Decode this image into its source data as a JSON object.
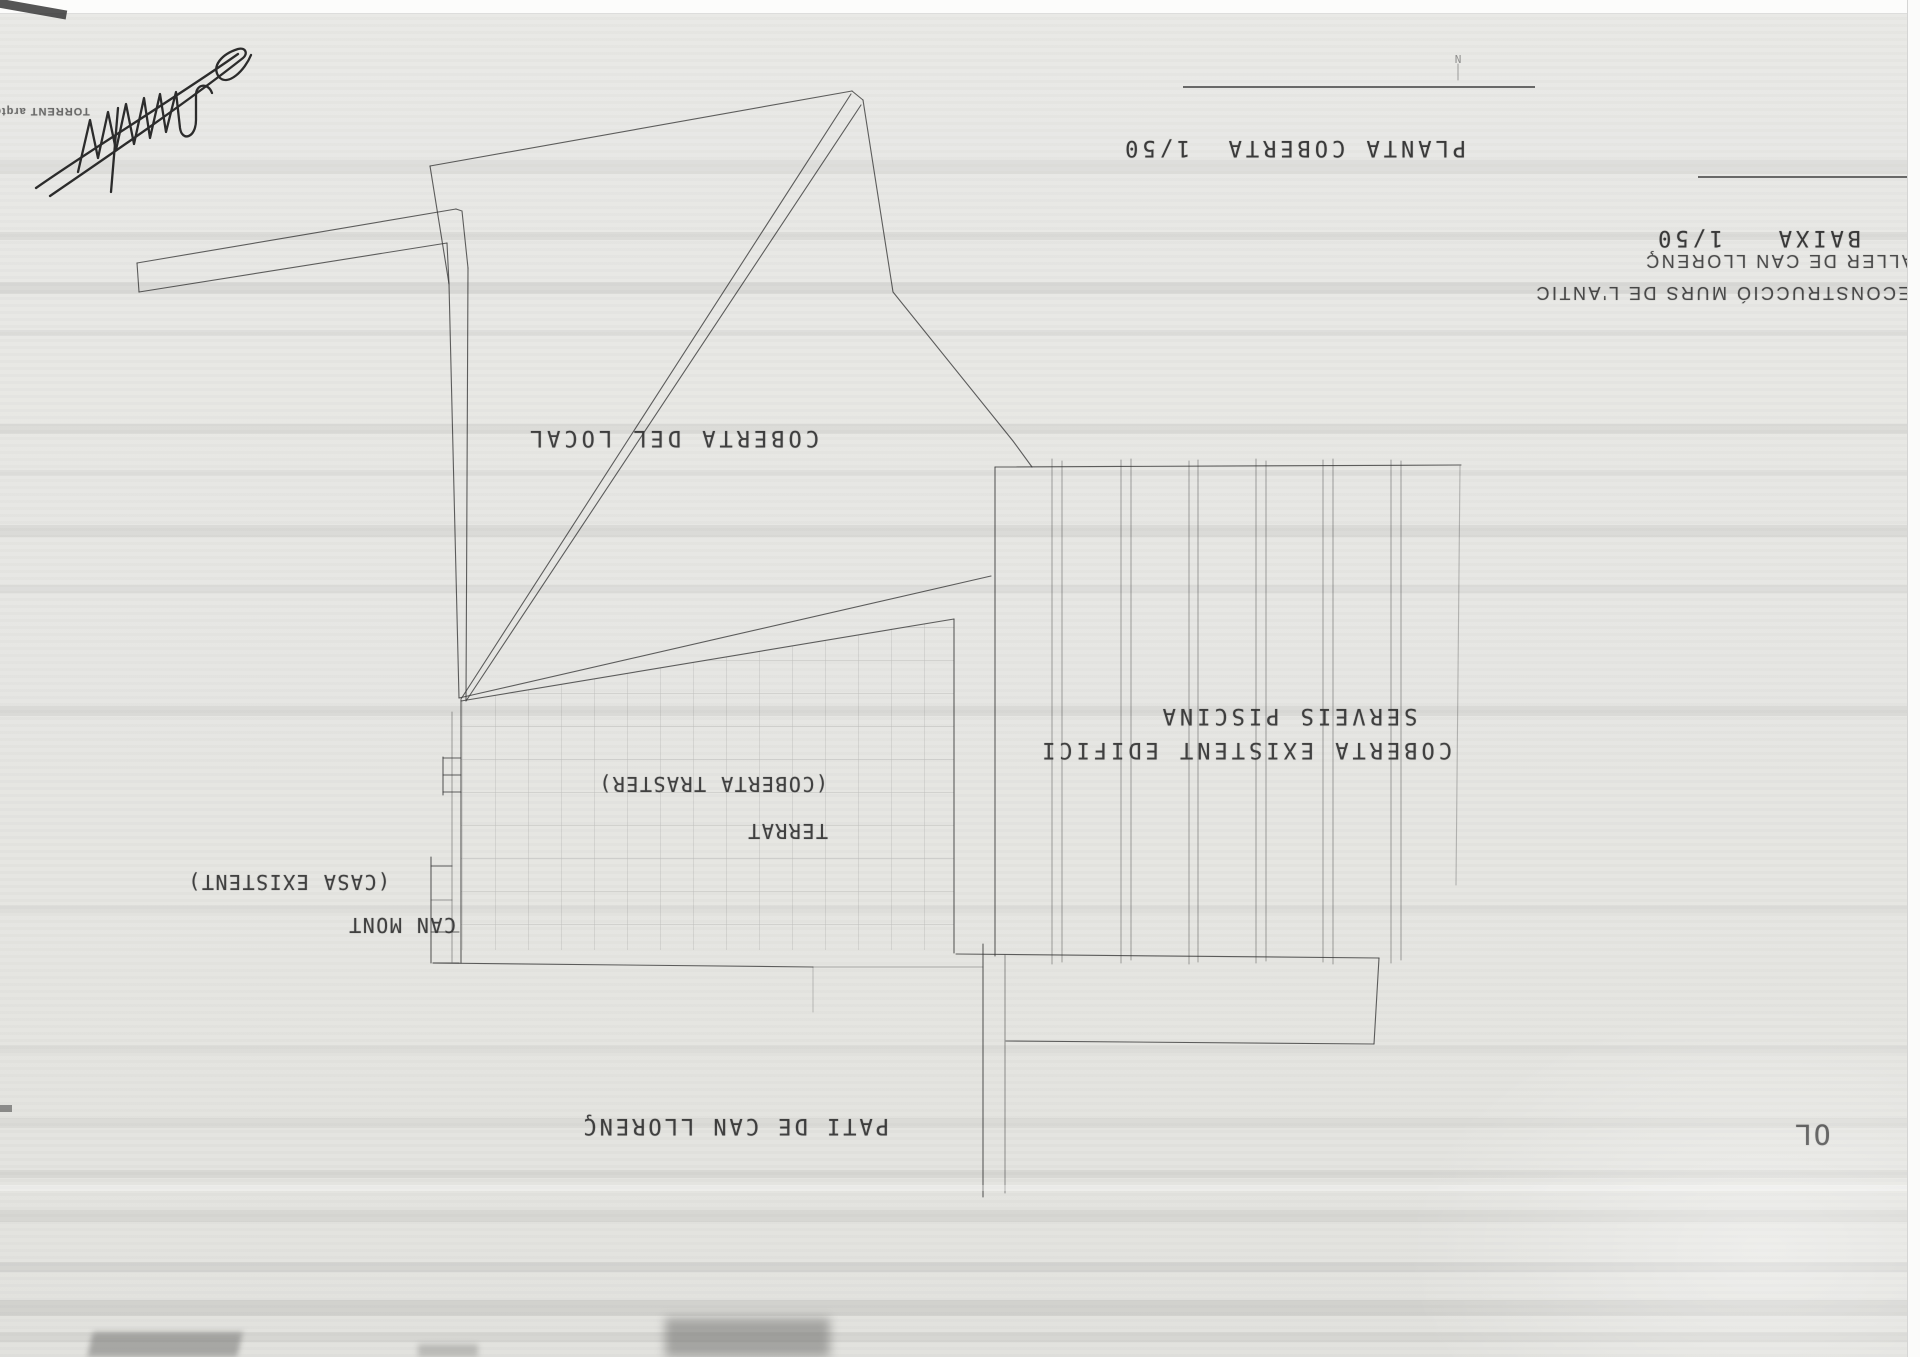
{
  "titles": {
    "plan_title": "PLANTA COBERTA  1/50",
    "secondary_plan_title": "BAIXA   1/50",
    "project_line1": "RECONSTRUCCIÓ MURS DE L'ANTIC",
    "project_line2": "TALLER DE CAN LLORENÇ"
  },
  "plan_labels": {
    "roof_local": "COBERTA DEL LOCAL",
    "existing_roof_line1": "COBERTA EXISTENT EDIFICI",
    "existing_roof_line2": "SERVEIS PISCINA",
    "terrace_line1": "TERRAT",
    "terrace_line2": "(COBERTA TRASTER)",
    "neighbor_line1": "CAN MONT",
    "neighbor_line2": "(CASA EXISTENT)",
    "courtyard": "PATI DE CAN LLORENÇ",
    "edge_fragment": "OL",
    "north_mark": "N"
  },
  "stamp": {
    "architect": "TORRENT arqte"
  },
  "colors": {
    "paper": "#e7e7e4",
    "pencil_line": "#3c3c3c",
    "label_text": "#343434"
  }
}
